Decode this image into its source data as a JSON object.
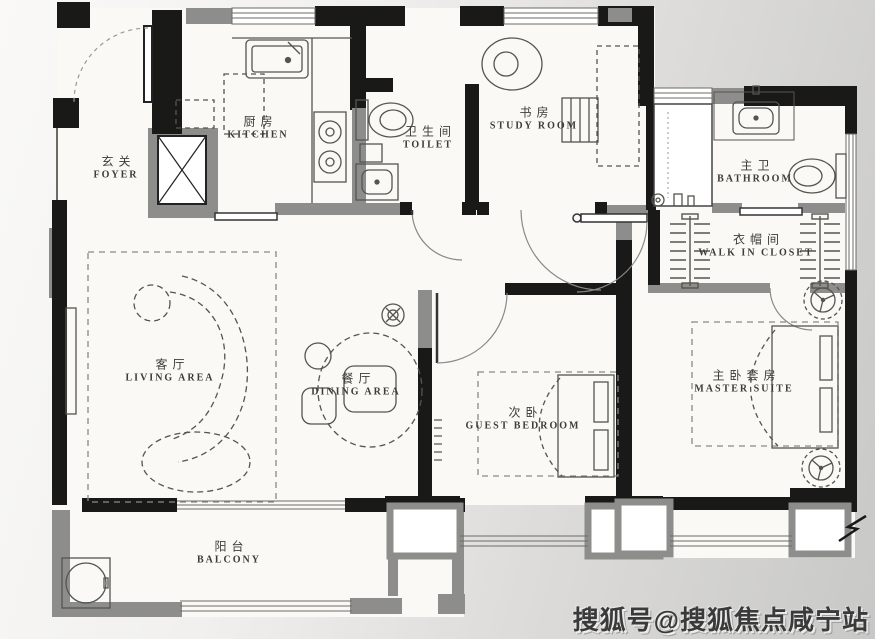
{
  "floorplan": {
    "rooms": [
      {
        "id": "foyer",
        "zh": "玄关",
        "en": "FOYER"
      },
      {
        "id": "kitchen",
        "zh": "厨房",
        "en": "KITCHEN"
      },
      {
        "id": "toilet",
        "zh": "卫生间",
        "en": "TOILET"
      },
      {
        "id": "study",
        "zh": "书房",
        "en": "STUDY ROOM"
      },
      {
        "id": "bathroom",
        "zh": "主卫",
        "en": "BATHROOM"
      },
      {
        "id": "closet",
        "zh": "衣帽间",
        "en": "WALK IN CLOSET"
      },
      {
        "id": "living",
        "zh": "客厅",
        "en": "LIVING AREA"
      },
      {
        "id": "dining",
        "zh": "餐厅",
        "en": "DINING AREA"
      },
      {
        "id": "guest",
        "zh": "次卧",
        "en": "GUEST BEDROOM"
      },
      {
        "id": "master",
        "zh": "主卧套房",
        "en": "MASTER SUITE"
      },
      {
        "id": "balcony",
        "zh": "阳台",
        "en": "BALCONY"
      }
    ],
    "colors": {
      "wall": "#191918",
      "secondary_wall": "#8d8d8c",
      "line": "#4a4a46",
      "floor": "#faf9f6"
    }
  },
  "watermark": {
    "text": "搜狐号@搜狐焦点咸宁站"
  }
}
